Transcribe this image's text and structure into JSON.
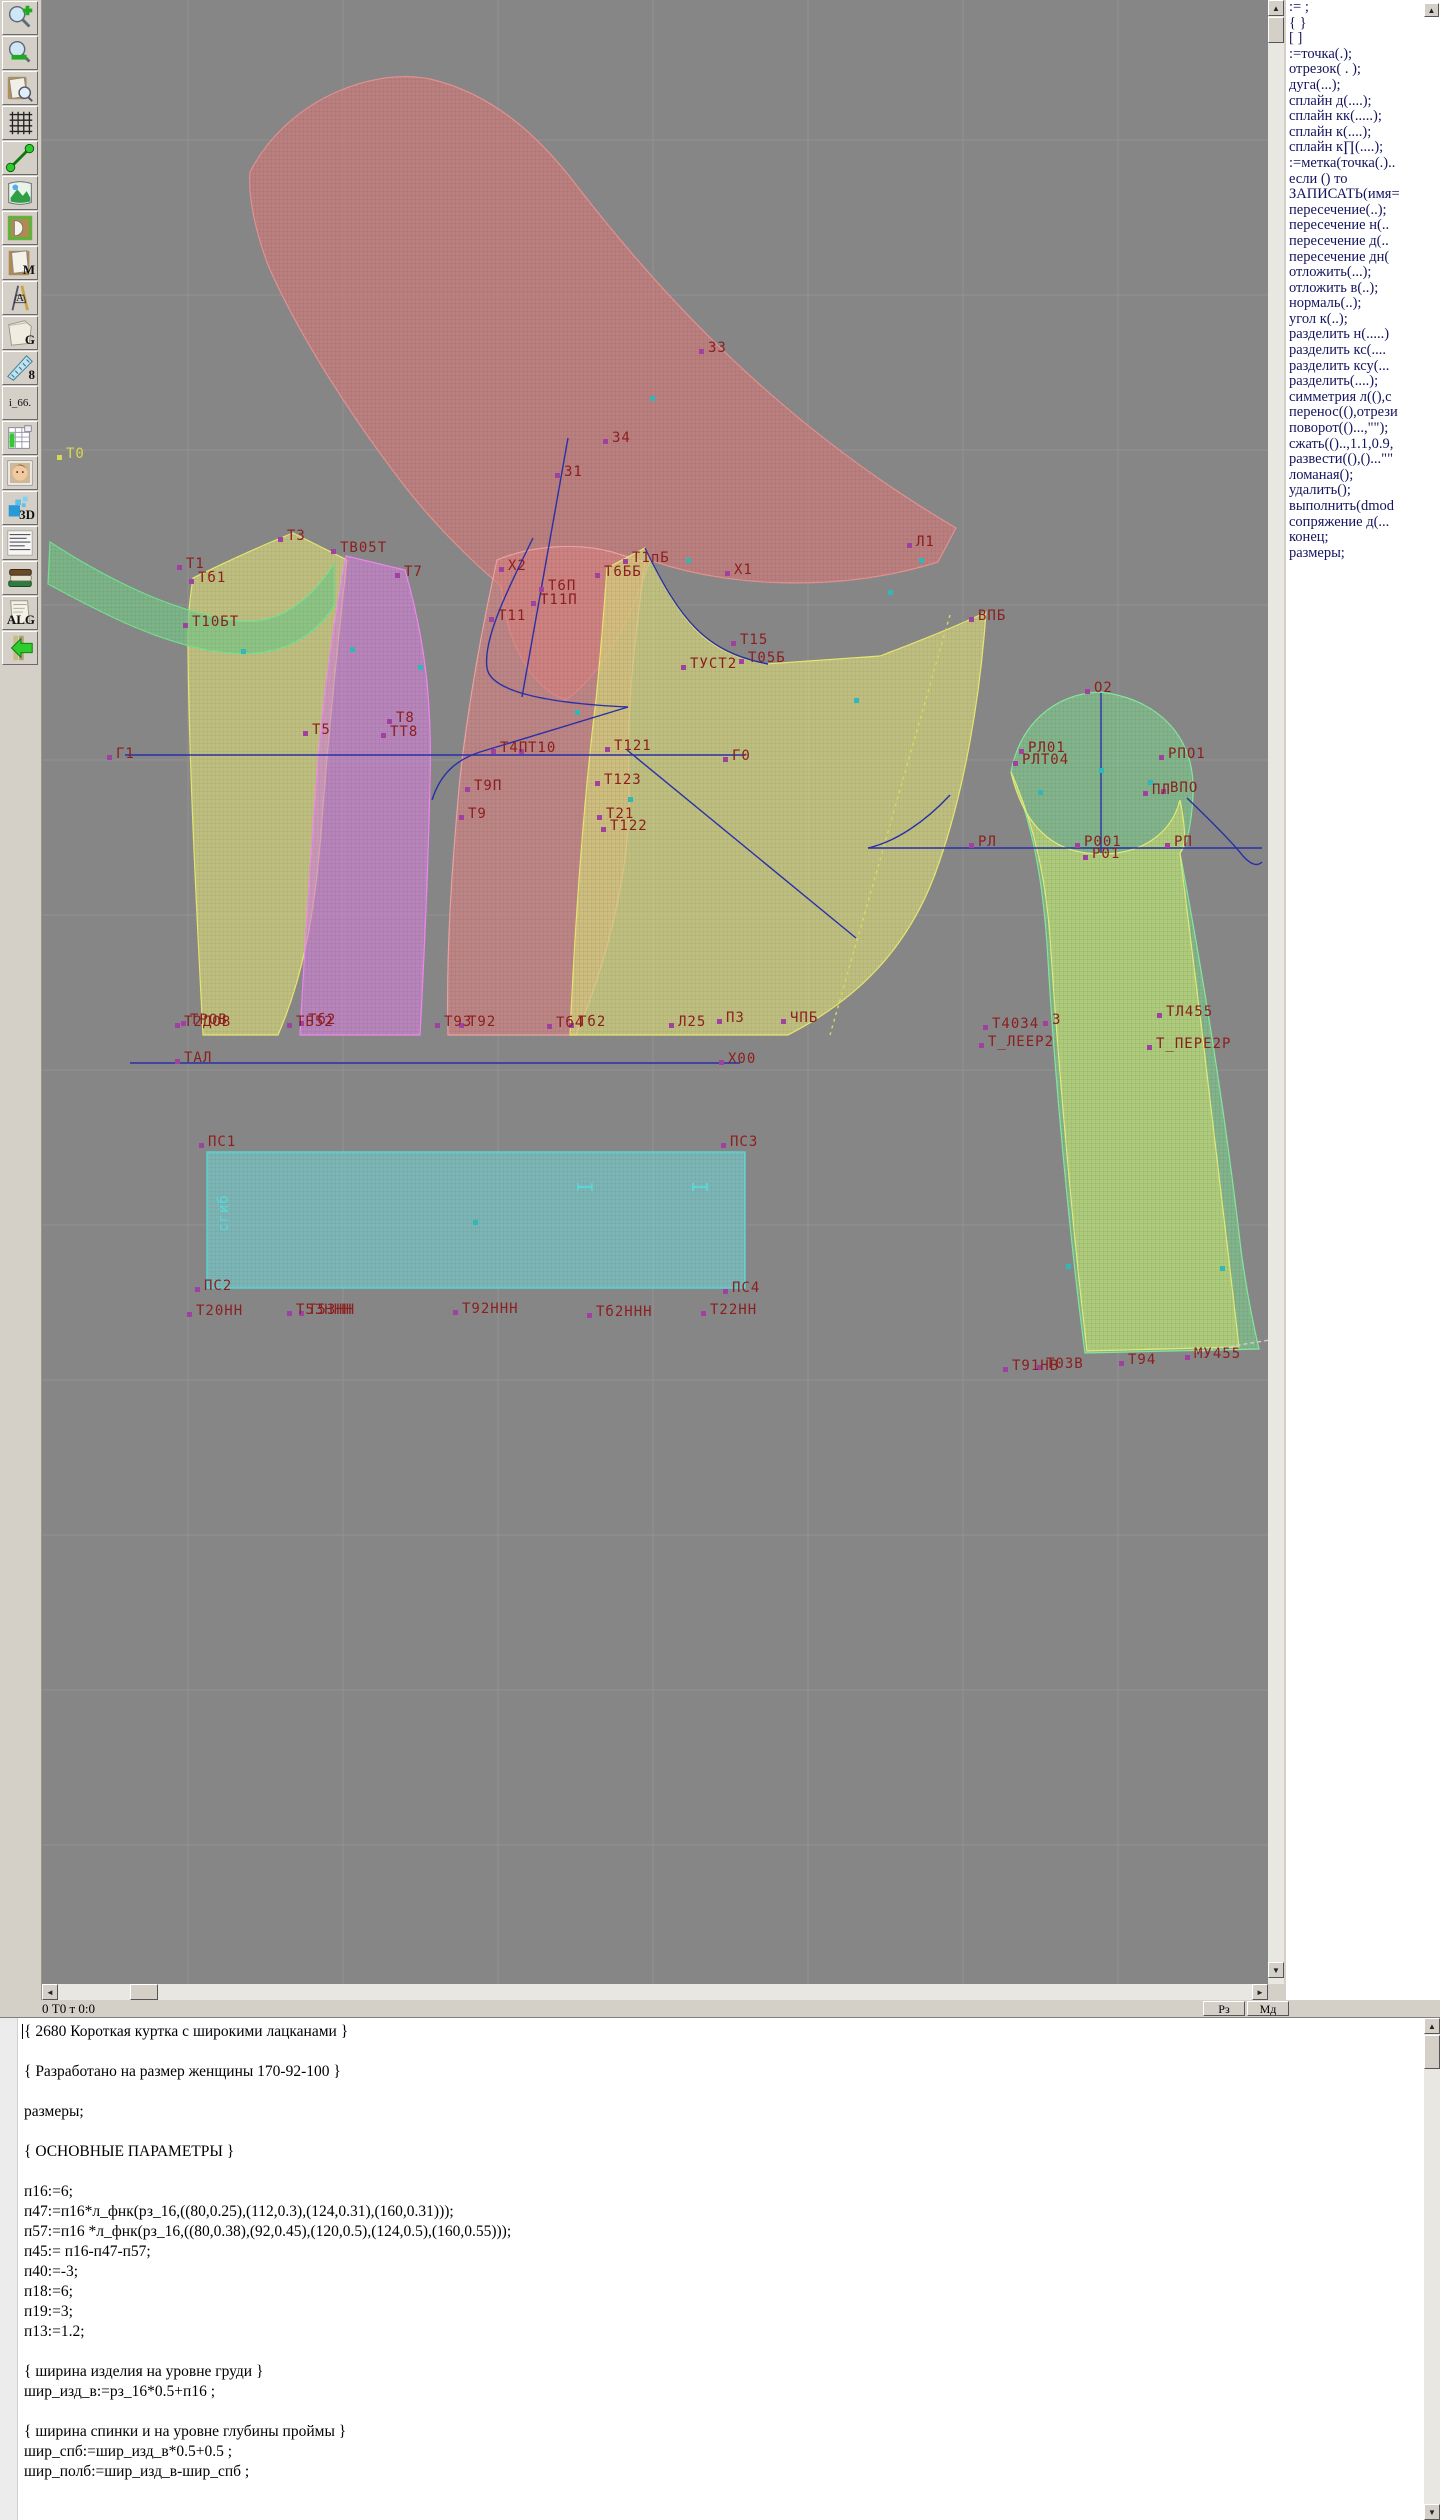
{
  "toolbar": {
    "items": [
      {
        "name": "zoom-in-button"
      },
      {
        "name": "zoom-out-button"
      },
      {
        "name": "page-preview-button"
      },
      {
        "name": "grid-button"
      },
      {
        "name": "measure-segment-button"
      },
      {
        "name": "image-view-button"
      },
      {
        "name": "pattern-piece-button"
      },
      {
        "name": "m-document-button",
        "label": "M"
      },
      {
        "name": "drafting-tools-button",
        "label": "A"
      },
      {
        "name": "g-document-button",
        "label": "G"
      },
      {
        "name": "blue-ruler-button",
        "label": "8"
      },
      {
        "name": "i66-button",
        "label": "i_66."
      },
      {
        "name": "size-table-button"
      },
      {
        "name": "portrait-button"
      },
      {
        "name": "three-d-button",
        "label": "3D"
      },
      {
        "name": "text-list-button"
      },
      {
        "name": "books-button"
      },
      {
        "name": "alg-document-button",
        "label": "ALG"
      },
      {
        "name": "exit-arrow-button"
      }
    ]
  },
  "statusbar": {
    "left_text": "0  Т0 т 0:0",
    "btn1": "Рз",
    "btn2": "Мд"
  },
  "right_panel": {
    "commands": [
      ":= ;",
      "{  }",
      "[  ]",
      ":=точка(.);",
      "отрезок( . );",
      "дуга(...);",
      "сплайн  д(....);",
      "сплайн  кк(.....);",
      "сплайн  к(....);",
      "сплайн  к∏(....);",
      ":=метка(точка(.)..",
      "если () то",
      "ЗАПИСАТЬ(имя=",
      "пересечение(..);",
      "пересечение  н(..",
      "пересечение  д(..",
      "пересечение  дн(",
      "отложить(...);",
      "отложить  в(..);",
      "нормаль(..);",
      "угол  к(..);",
      "разделить  н(.....)",
      "разделить  кс(....",
      "разделить  ксу(...",
      "разделить(....);",
      "симметрия  л((),c",
      "перенос((),отрези",
      "поворот(()...,\"\");",
      "сжать(()..,1.1,0.9,",
      "развести((),()...\"\"",
      "ломаная();",
      "удалить();",
      "выполнить(dmod",
      "сопряжение  д(...",
      "конец;",
      "размеры;"
    ]
  },
  "canvas": {
    "bg": "#868686",
    "grid_color": "#929292",
    "label_color": "#8b1e1e",
    "line_color": "#2830a8",
    "pieces": [
      {
        "name": "sleeve-upper-red",
        "pat": "patRed",
        "stroke": "#e09090",
        "d": "M 250,172 C 290,95 380,66 434,80 C 497,96 542,140 577,186 C 662,296 782,426 956,528 L 938,562 C 836,594 722,586 650,560 C 630,622 602,674 566,700 C 530,688 506,640 501,586 C 470,560 430,520 400,480 C 350,415 296,330 268,265 C 255,230 248,196 250,172 Z"
      },
      {
        "name": "front-side-panel-pink",
        "pat": "patPink",
        "stroke": "#eaa0a0",
        "d": "M 497,560 C 530,546 576,542 612,552 L 645,562 C 633,650 626,720 629,790 C 631,880 600,980 576,1035 L 448,1035 C 446,950 452,870 458,800 C 463,740 477,650 497,560 Z"
      },
      {
        "name": "back-piece-yellow",
        "pat": "patYellow",
        "stroke": "#e4e470",
        "d": "M 193,578 C 226,562 260,546 293,533 L 347,560 C 337,650 328,740 322,820 C 315,920 301,982 278,1035 L 203,1035 C 196,900 189,760 188,650 C 187,620 190,598 193,578 Z"
      },
      {
        "name": "side-panel-magenta",
        "pat": "patMagenta",
        "stroke": "#ec86ec",
        "d": "M 346,556 L 405,570 C 425,640 432,700 430,780 C 428,880 424,960 420,1035 L 300,1035 C 305,940 312,840 318,760 C 325,680 335,615 346,556 Z"
      },
      {
        "name": "collar-green",
        "pat": "patGreen",
        "stroke": "#72de8c",
        "d": "M 50,542 C 115,584 180,614 240,621 C 282,625 312,598 334,564 L 334,606 C 306,650 260,659 214,651 C 156,642 96,610 48,584 Z"
      },
      {
        "name": "front-piece-yellow",
        "pat": "patYellow",
        "stroke": "#e4e470",
        "d": "M 607,568 L 645,548 C 680,620 702,652 766,664 L 880,656 C 922,640 962,624 986,612 C 980,700 964,790 940,860 C 910,952 852,1002 788,1035 L 570,1035 C 576,900 586,780 596,700 C 601,650 604,610 607,568 Z"
      },
      {
        "name": "sleeve-green",
        "pat": "patGreenLt",
        "stroke": "#84e49c",
        "d": "M 1100,692 C 1158,699 1196,736 1193,796 C 1191,830 1186,846 1180,853 C 1204,980 1226,1120 1241,1250 C 1248,1302 1255,1332 1259,1349 L 1085,1353 C 1070,1240 1055,1080 1048,960 C 1044,890 1035,830 1011,772 C 1020,724 1054,694 1100,692 Z"
      },
      {
        "name": "undersleeve-yellow",
        "pat": "patYelGreen",
        "stroke": "#e0e878",
        "d": "M 1011,772 C 1026,836 1062,854 1101,854 C 1144,854 1172,832 1180,800 C 1186,830 1186,845 1180,853 C 1196,980 1214,1130 1228,1252 L 1239,1347 L 1087,1351 C 1073,1232 1059,1072 1051,952 C 1047,882 1035,826 1011,772 Z"
      },
      {
        "name": "waistband-cyan",
        "pat": "patCyan",
        "stroke": "#50e0e0",
        "d": "M 207,1152 L 745,1152 L 745,1288 L 207,1288 Z"
      }
    ],
    "lines": [
      {
        "name": "chest-line",
        "d": "M 125,755 H 745"
      },
      {
        "name": "waist-line",
        "d": "M 130,1063 H 740"
      },
      {
        "name": "sleeve-base-line",
        "d": "M 868,848 H 1262"
      },
      {
        "name": "sleeve-axis",
        "d": "M 1101,693 V 853"
      },
      {
        "name": "shoulder-diagonal",
        "d": "M 568,438 L 522,697"
      },
      {
        "name": "armhole-spline",
        "d": "M 533,538 C 505,595 483,640 487,668 C 490,690 540,703 628,707"
      },
      {
        "name": "lapel-line",
        "d": "M 628,707 L 480,752 C 455,760 440,775 432,800"
      },
      {
        "name": "front-diagonal",
        "d": "M 627,750 L 856,938"
      },
      {
        "name": "sleeve-curve-left",
        "d": "M 950,795 C 925,822 895,842 868,848"
      },
      {
        "name": "sleeve-curve-right",
        "d": "M 1187,798 C 1212,822 1232,842 1243,856 C 1252,866 1258,866 1262,862"
      },
      {
        "name": "front-armhole-curve",
        "d": "M 645,548 C 680,620 705,652 768,664"
      },
      {
        "name": "front-dart-dashed",
        "d": "M 950,615 L 830,1035",
        "stroke": "#d8d860",
        "dash": "3,4"
      },
      {
        "name": "hem-dashed",
        "d": "M 1195,1352 L 1270,1340",
        "stroke": "#cccccc",
        "dash": "4,3"
      }
    ],
    "labels": [
      {
        "t": "Т0",
        "x": 66,
        "y": 458,
        "c": "#d8d850"
      },
      {
        "t": "З3",
        "x": 708,
        "y": 352
      },
      {
        "t": "З4",
        "x": 612,
        "y": 442
      },
      {
        "t": "З1",
        "x": 564,
        "y": 476
      },
      {
        "t": "Т3",
        "x": 287,
        "y": 540
      },
      {
        "t": "ТВ05Т",
        "x": 340,
        "y": 552
      },
      {
        "t": "Т1",
        "x": 186,
        "y": 568
      },
      {
        "t": "Тб1",
        "x": 198,
        "y": 582
      },
      {
        "t": "Т7",
        "x": 404,
        "y": 576
      },
      {
        "t": "Т10БТ",
        "x": 192,
        "y": 626
      },
      {
        "t": "Х2",
        "x": 508,
        "y": 570
      },
      {
        "t": "Т1пБ",
        "x": 632,
        "y": 562
      },
      {
        "t": "Т6ББ",
        "x": 604,
        "y": 576
      },
      {
        "t": "Т6П",
        "x": 548,
        "y": 590
      },
      {
        "t": "Т11П",
        "x": 540,
        "y": 604
      },
      {
        "t": "Т11",
        "x": 498,
        "y": 620
      },
      {
        "t": "Х1",
        "x": 734,
        "y": 574
      },
      {
        "t": "Л1",
        "x": 916,
        "y": 546
      },
      {
        "t": "ВПБ",
        "x": 978,
        "y": 620
      },
      {
        "t": "Т15",
        "x": 740,
        "y": 644
      },
      {
        "t": "ТУСТ2",
        "x": 690,
        "y": 668
      },
      {
        "t": "Т05Б",
        "x": 748,
        "y": 662
      },
      {
        "t": "Т8",
        "x": 396,
        "y": 722
      },
      {
        "t": "ТТ8",
        "x": 390,
        "y": 736
      },
      {
        "t": "Т5",
        "x": 312,
        "y": 734
      },
      {
        "t": "Г1",
        "x": 116,
        "y": 758
      },
      {
        "t": "Т4П",
        "x": 500,
        "y": 752
      },
      {
        "t": "Т10",
        "x": 528,
        "y": 752
      },
      {
        "t": "Т121",
        "x": 614,
        "y": 750
      },
      {
        "t": "Г0",
        "x": 732,
        "y": 760
      },
      {
        "t": "Т9П",
        "x": 474,
        "y": 790
      },
      {
        "t": "Т123",
        "x": 604,
        "y": 784
      },
      {
        "t": "Т9",
        "x": 468,
        "y": 818
      },
      {
        "t": "Т21",
        "x": 606,
        "y": 818
      },
      {
        "t": "Т122",
        "x": 610,
        "y": 830
      },
      {
        "t": "О2",
        "x": 1094,
        "y": 692
      },
      {
        "t": "РЛ01",
        "x": 1028,
        "y": 752
      },
      {
        "t": "РЛТ04",
        "x": 1022,
        "y": 764
      },
      {
        "t": "РПО1",
        "x": 1168,
        "y": 758
      },
      {
        "t": "ПЛ",
        "x": 1152,
        "y": 794
      },
      {
        "t": "ВПО",
        "x": 1170,
        "y": 792
      },
      {
        "t": "РЛ",
        "x": 978,
        "y": 846
      },
      {
        "t": "Р001",
        "x": 1084,
        "y": 846
      },
      {
        "t": "Р01",
        "x": 1092,
        "y": 858
      },
      {
        "t": "РП",
        "x": 1174,
        "y": 846
      },
      {
        "t": "Т2ДОВ",
        "x": 184,
        "y": 1026
      },
      {
        "t": "ТРОВ",
        "x": 190,
        "y": 1024
      },
      {
        "t": "ТБ52",
        "x": 296,
        "y": 1026
      },
      {
        "t": "Тб2",
        "x": 308,
        "y": 1024
      },
      {
        "t": "Т93",
        "x": 444,
        "y": 1026
      },
      {
        "t": "Т92",
        "x": 468,
        "y": 1026
      },
      {
        "t": "Тб4",
        "x": 556,
        "y": 1027
      },
      {
        "t": "Тб2",
        "x": 578,
        "y": 1026
      },
      {
        "t": "Л25",
        "x": 678,
        "y": 1026
      },
      {
        "t": "ПЗ",
        "x": 726,
        "y": 1022
      },
      {
        "t": "ЧПБ",
        "x": 790,
        "y": 1022
      },
      {
        "t": "ТАЛ",
        "x": 184,
        "y": 1062
      },
      {
        "t": "Х00",
        "x": 728,
        "y": 1063
      },
      {
        "t": "Т40З4",
        "x": 992,
        "y": 1028
      },
      {
        "t": "3",
        "x": 1052,
        "y": 1024
      },
      {
        "t": "Т_ЛЕЕР2",
        "x": 988,
        "y": 1046
      },
      {
        "t": "ТЛ455",
        "x": 1166,
        "y": 1016
      },
      {
        "t": "Т_ПЕРЕ2Р",
        "x": 1156,
        "y": 1048
      },
      {
        "t": "ПС1",
        "x": 208,
        "y": 1146
      },
      {
        "t": "ПС3",
        "x": 730,
        "y": 1146
      },
      {
        "t": "ПС2",
        "x": 204,
        "y": 1290
      },
      {
        "t": "ПС4",
        "x": 732,
        "y": 1292
      },
      {
        "t": "Т20НН",
        "x": 196,
        "y": 1315
      },
      {
        "t": "Т5ЗННН",
        "x": 296,
        "y": 1314
      },
      {
        "t": "Т53НН",
        "x": 308,
        "y": 1314
      },
      {
        "t": "Т92ННН",
        "x": 462,
        "y": 1313
      },
      {
        "t": "Тб2ННН",
        "x": 596,
        "y": 1316
      },
      {
        "t": "Т22НН",
        "x": 710,
        "y": 1314
      },
      {
        "t": "Т91НВ",
        "x": 1012,
        "y": 1370
      },
      {
        "t": "Т0ЗВ",
        "x": 1046,
        "y": 1368
      },
      {
        "t": "Т94",
        "x": 1128,
        "y": 1364
      },
      {
        "t": "МУ455",
        "x": 1194,
        "y": 1358
      },
      {
        "t": "сгиб",
        "x": 228,
        "y": 1232,
        "c": "#58d8d8",
        "rot": -90,
        "nm": 1
      }
    ],
    "teal_markers": [
      [
        652,
        398
      ],
      [
        243,
        651
      ],
      [
        352,
        649
      ],
      [
        420,
        667
      ],
      [
        577,
        712
      ],
      [
        688,
        560
      ],
      [
        856,
        700
      ],
      [
        921,
        560
      ],
      [
        630,
        799
      ],
      [
        1040,
        792
      ],
      [
        1150,
        782
      ],
      [
        1068,
        1266
      ],
      [
        1222,
        1268
      ],
      [
        475,
        1222
      ],
      [
        1101,
        770
      ],
      [
        890,
        592
      ]
    ],
    "h_markers": [
      [
        585,
        1187
      ],
      [
        700,
        1187
      ]
    ]
  },
  "editor": {
    "lines": [
      "{ 2680 Короткая куртка с широкими лацканами }",
      "",
      "{ Разработано на размер женщины 170-92-100 }",
      "",
      "размеры;",
      "",
      "{ ОСНОВНЫЕ ПАРАМЕТРЫ }",
      "",
      "п16:=6;",
      "п47:=п16*л_фнк(рз_16,((80,0.25),(112,0.3),(124,0.31),(160,0.31)));",
      "п57:=п16 *л_фнк(рз_16,((80,0.38),(92,0.45),(120,0.5),(124,0.5),(160,0.55)));",
      "п45:= п16-п47-п57;",
      "п40:=-3;",
      "п18:=6;",
      "п19:=3;",
      "п13:=1.2;",
      "",
      "{ ширина изделия на уровне груди }",
      "шир_изд_в:=рз_16*0.5+п16 ;",
      "",
      "{ ширина спинки и на уровне глубины проймы }",
      "шир_спб:=шир_изд_в*0.5+0.5 ;",
      "шир_полб:=шир_изд_в-шир_спб ;"
    ]
  }
}
